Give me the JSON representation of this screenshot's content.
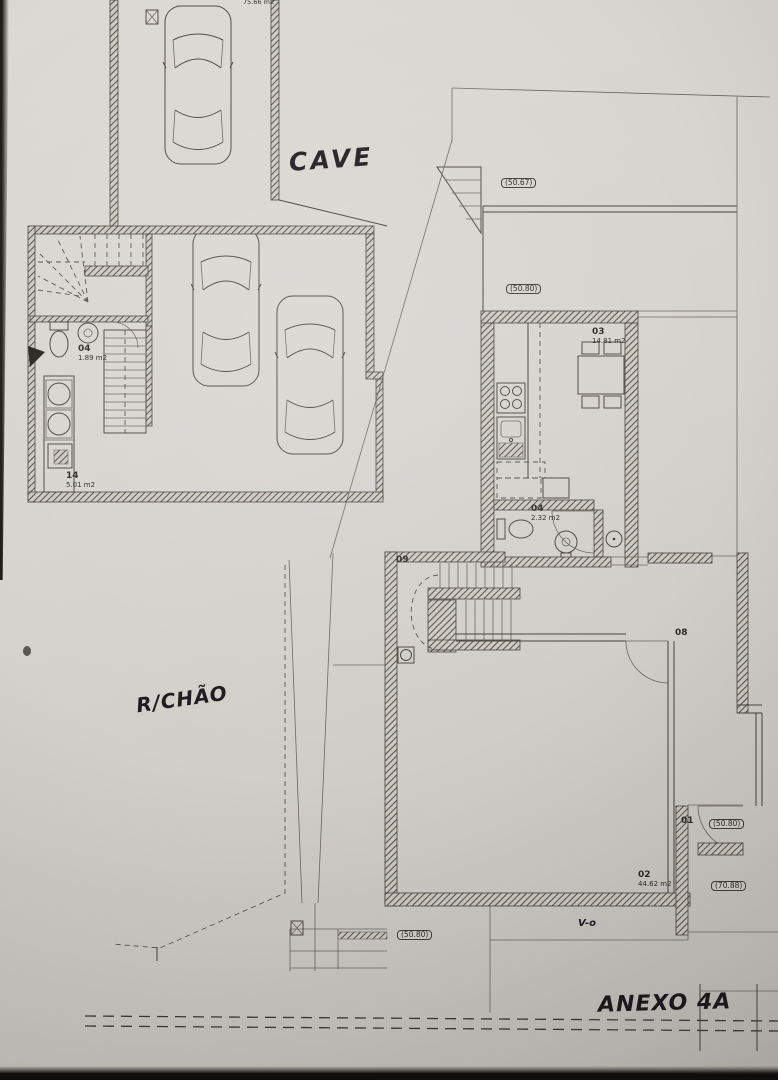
{
  "photo": {
    "paper_color": "#d7d4cf",
    "ink_color": "#45403a"
  },
  "titles": {
    "cave": "CAVE",
    "ground_floor": "R/CHÃO",
    "annex": "ANEXO 4A"
  },
  "labels": {
    "total_area": "75.66 m2",
    "window_mark": "V-o"
  },
  "rooms": [
    {
      "id": "03",
      "area": "14.81 m2"
    },
    {
      "id": "04",
      "area": "2.32 m2"
    },
    {
      "id": "04",
      "area": "1.89 m2"
    },
    {
      "id": "14",
      "area": "5.01 m2"
    },
    {
      "id": "09",
      "area": ""
    },
    {
      "id": "08",
      "area": ""
    },
    {
      "id": "01",
      "area": ""
    },
    {
      "id": "02",
      "area": "44.62 m2"
    }
  ],
  "dimensions": [
    {
      "value": "(50.67)"
    },
    {
      "value": "(50.80)"
    },
    {
      "value": "(50.80)"
    },
    {
      "value": "(70.88)"
    },
    {
      "value": "(50.80)"
    }
  ]
}
